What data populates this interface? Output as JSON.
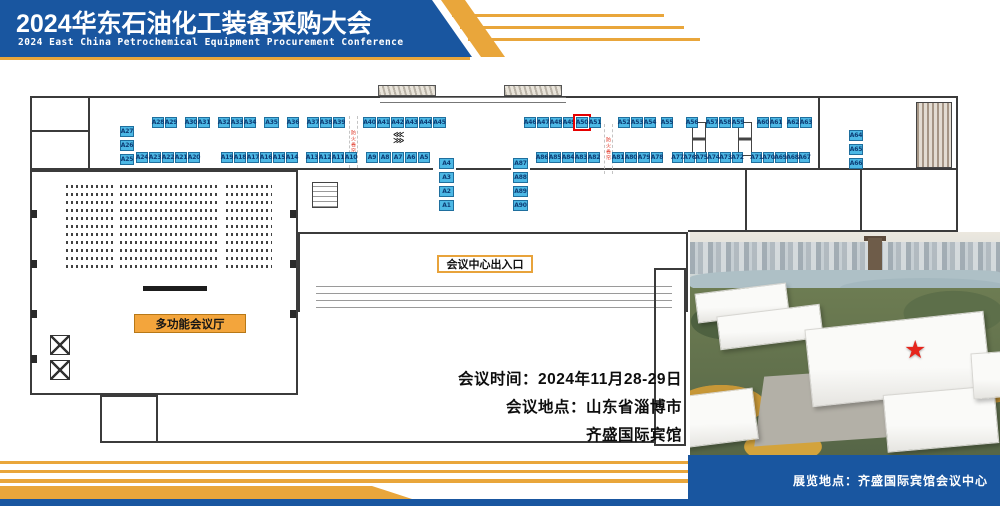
{
  "header": {
    "title": "2024华东石油化工装备采购大会",
    "subtitle": "2024 East China Petrochemical Equipment Procurement Conference"
  },
  "colors": {
    "brand_blue": "#1956a0",
    "gold": "#e9a63b",
    "booth_fill": "#4db8e5",
    "booth_text": "#0d3c74",
    "highlight_red": "#e60000"
  },
  "floor_plan": {
    "labels": {
      "multi_hall": "多功能会议厅",
      "entrance": "会议中心出入口",
      "fire_shutter": "防火卷帘"
    },
    "icons": {
      "arrows_left": "⋘",
      "arrows_right": "⋙"
    },
    "highlight_booth": "A50",
    "seating_rows": 11,
    "booth_groups": [
      {
        "x": 120,
        "y": 126,
        "dir": "v",
        "w": 14,
        "booths": [
          "A27",
          "A26",
          "A25"
        ]
      },
      {
        "x": 152,
        "y": 117,
        "booths": [
          "A28",
          "A29"
        ]
      },
      {
        "x": 185,
        "y": 117,
        "booths": [
          "A30",
          "A31"
        ]
      },
      {
        "x": 218,
        "y": 117,
        "booths": [
          "A32",
          "A33",
          "A34"
        ]
      },
      {
        "x": 264,
        "y": 117,
        "w": 15,
        "booths": [
          "A35"
        ]
      },
      {
        "x": 287,
        "y": 117,
        "booths": [
          "A36"
        ]
      },
      {
        "x": 307,
        "y": 117,
        "booths": [
          "A37",
          "A38",
          "A39"
        ]
      },
      {
        "x": 363,
        "y": 117,
        "w": 13,
        "booths": [
          "A40",
          "A41",
          "A42",
          "A43",
          "A44",
          "A45"
        ]
      },
      {
        "x": 524,
        "y": 117,
        "booths": [
          "A46",
          "A47",
          "A48",
          "A49",
          "A50",
          "A51"
        ]
      },
      {
        "x": 618,
        "y": 117,
        "booths": [
          "A52",
          "A53",
          "A54"
        ]
      },
      {
        "x": 661,
        "y": 117,
        "booths": [
          "A55"
        ]
      },
      {
        "x": 686,
        "y": 117,
        "booths": [
          "A56"
        ]
      },
      {
        "x": 706,
        "y": 117,
        "booths": [
          "A57",
          "A58",
          "A59"
        ]
      },
      {
        "x": 757,
        "y": 117,
        "booths": [
          "A60",
          "A61"
        ]
      },
      {
        "x": 787,
        "y": 117,
        "booths": [
          "A62",
          "A63"
        ]
      },
      {
        "x": 849,
        "y": 130,
        "dir": "v",
        "w": 14,
        "booths": [
          "A64",
          "A65",
          "A66"
        ]
      },
      {
        "x": 136,
        "y": 152,
        "booths": [
          "A24",
          "A23",
          "A22",
          "A21",
          "A20"
        ]
      },
      {
        "x": 221,
        "y": 152,
        "booths": [
          "A19",
          "A18",
          "A17",
          "A16",
          "A15",
          "A14"
        ]
      },
      {
        "x": 306,
        "y": 152,
        "booths": [
          "A13",
          "A12",
          "A11",
          "A10"
        ]
      },
      {
        "x": 366,
        "y": 152,
        "booths": [
          "A9",
          "A8",
          "A7",
          "A6",
          "A5"
        ]
      },
      {
        "x": 439,
        "y": 158,
        "dir": "v",
        "w": 15,
        "booths": [
          "A4",
          "A3",
          "A2",
          "A1"
        ]
      },
      {
        "x": 513,
        "y": 158,
        "dir": "v",
        "w": 15,
        "booths": [
          "A87",
          "A88",
          "A89",
          "A90"
        ]
      },
      {
        "x": 536,
        "y": 152,
        "booths": [
          "A86",
          "A85",
          "A84",
          "A83",
          "A82"
        ]
      },
      {
        "x": 612,
        "y": 152,
        "booths": [
          "A81",
          "A80",
          "A79",
          "A78"
        ]
      },
      {
        "x": 672,
        "y": 152,
        "w": 11,
        "booths": [
          "A77",
          "A76",
          "A75",
          "A74",
          "A73",
          "A72"
        ]
      },
      {
        "x": 751,
        "y": 152,
        "w": 11,
        "booths": [
          "A71",
          "A70",
          "A69",
          "A68",
          "A67"
        ]
      }
    ]
  },
  "info": {
    "line1": "会议时间：2024年11月28-29日",
    "line2": "会议地点：山东省淄博市",
    "line3": "齐盛国际宾馆"
  },
  "footer": {
    "venue_label": "展览地点：齐盛国际宾馆会议中心"
  },
  "photo": {
    "marker": "red-star"
  }
}
